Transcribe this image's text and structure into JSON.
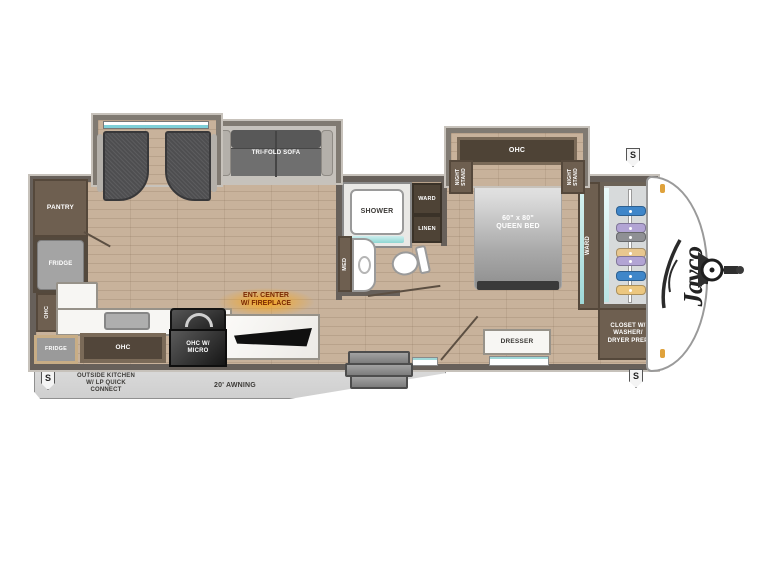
{
  "brand": "Jayco",
  "badge_letter": "S",
  "colors": {
    "wall": "#67605a",
    "floor_wood": "#c8b29b",
    "cabinet_brown": "#6e5f50",
    "cabinet_dark_brown": "#4e4336",
    "appliance_gray": "#9f9f9f",
    "appliance_black": "#242424",
    "ent_center_glow_orange": "#f6a21d",
    "window_teal": "#8fd6d2",
    "front_cap_white": "#ffffff"
  },
  "living": {
    "sofa": "TRI-FOLD SOFA",
    "pantry": "PANTRY",
    "fridge": "FRIDGE",
    "ohc_side": "OHC",
    "ent_line1": "ENT. CENTER",
    "ent_line2": "W/ FIREPLACE"
  },
  "kitchen": {
    "ohc": "OHC",
    "micro_line1": "OHC W/",
    "micro_line2": "MICRO",
    "outside_fridge": "FRIDGE"
  },
  "bath": {
    "shower": "SHOWER",
    "ward": "WARD",
    "linen": "LINEN",
    "med": "MED"
  },
  "bedroom": {
    "ohc": "OHC",
    "nightstand_line1": "NIGHT",
    "nightstand_line2": "STAND",
    "bed_line1": "60\" x 80\"",
    "bed_line2": "QUEEN BED",
    "ward": "WARD",
    "dresser": "DRESSER",
    "closet_line1": "CLOSET W/",
    "closet_line2": "WASHER/",
    "closet_line3": "DRYER PREP"
  },
  "exterior": {
    "awning": "20' AWNING",
    "outside_kitchen_line1": "OUTSIDE KITCHEN",
    "outside_kitchen_line2": "W/ LP QUICK",
    "outside_kitchen_line3": "CONNECT"
  },
  "closet_hangers": [
    "#3f86c9",
    "#b2a4d4",
    "#8f9094",
    "#e8c78f",
    "#b2a4d4",
    "#3f86c9",
    "#ecc77f"
  ]
}
